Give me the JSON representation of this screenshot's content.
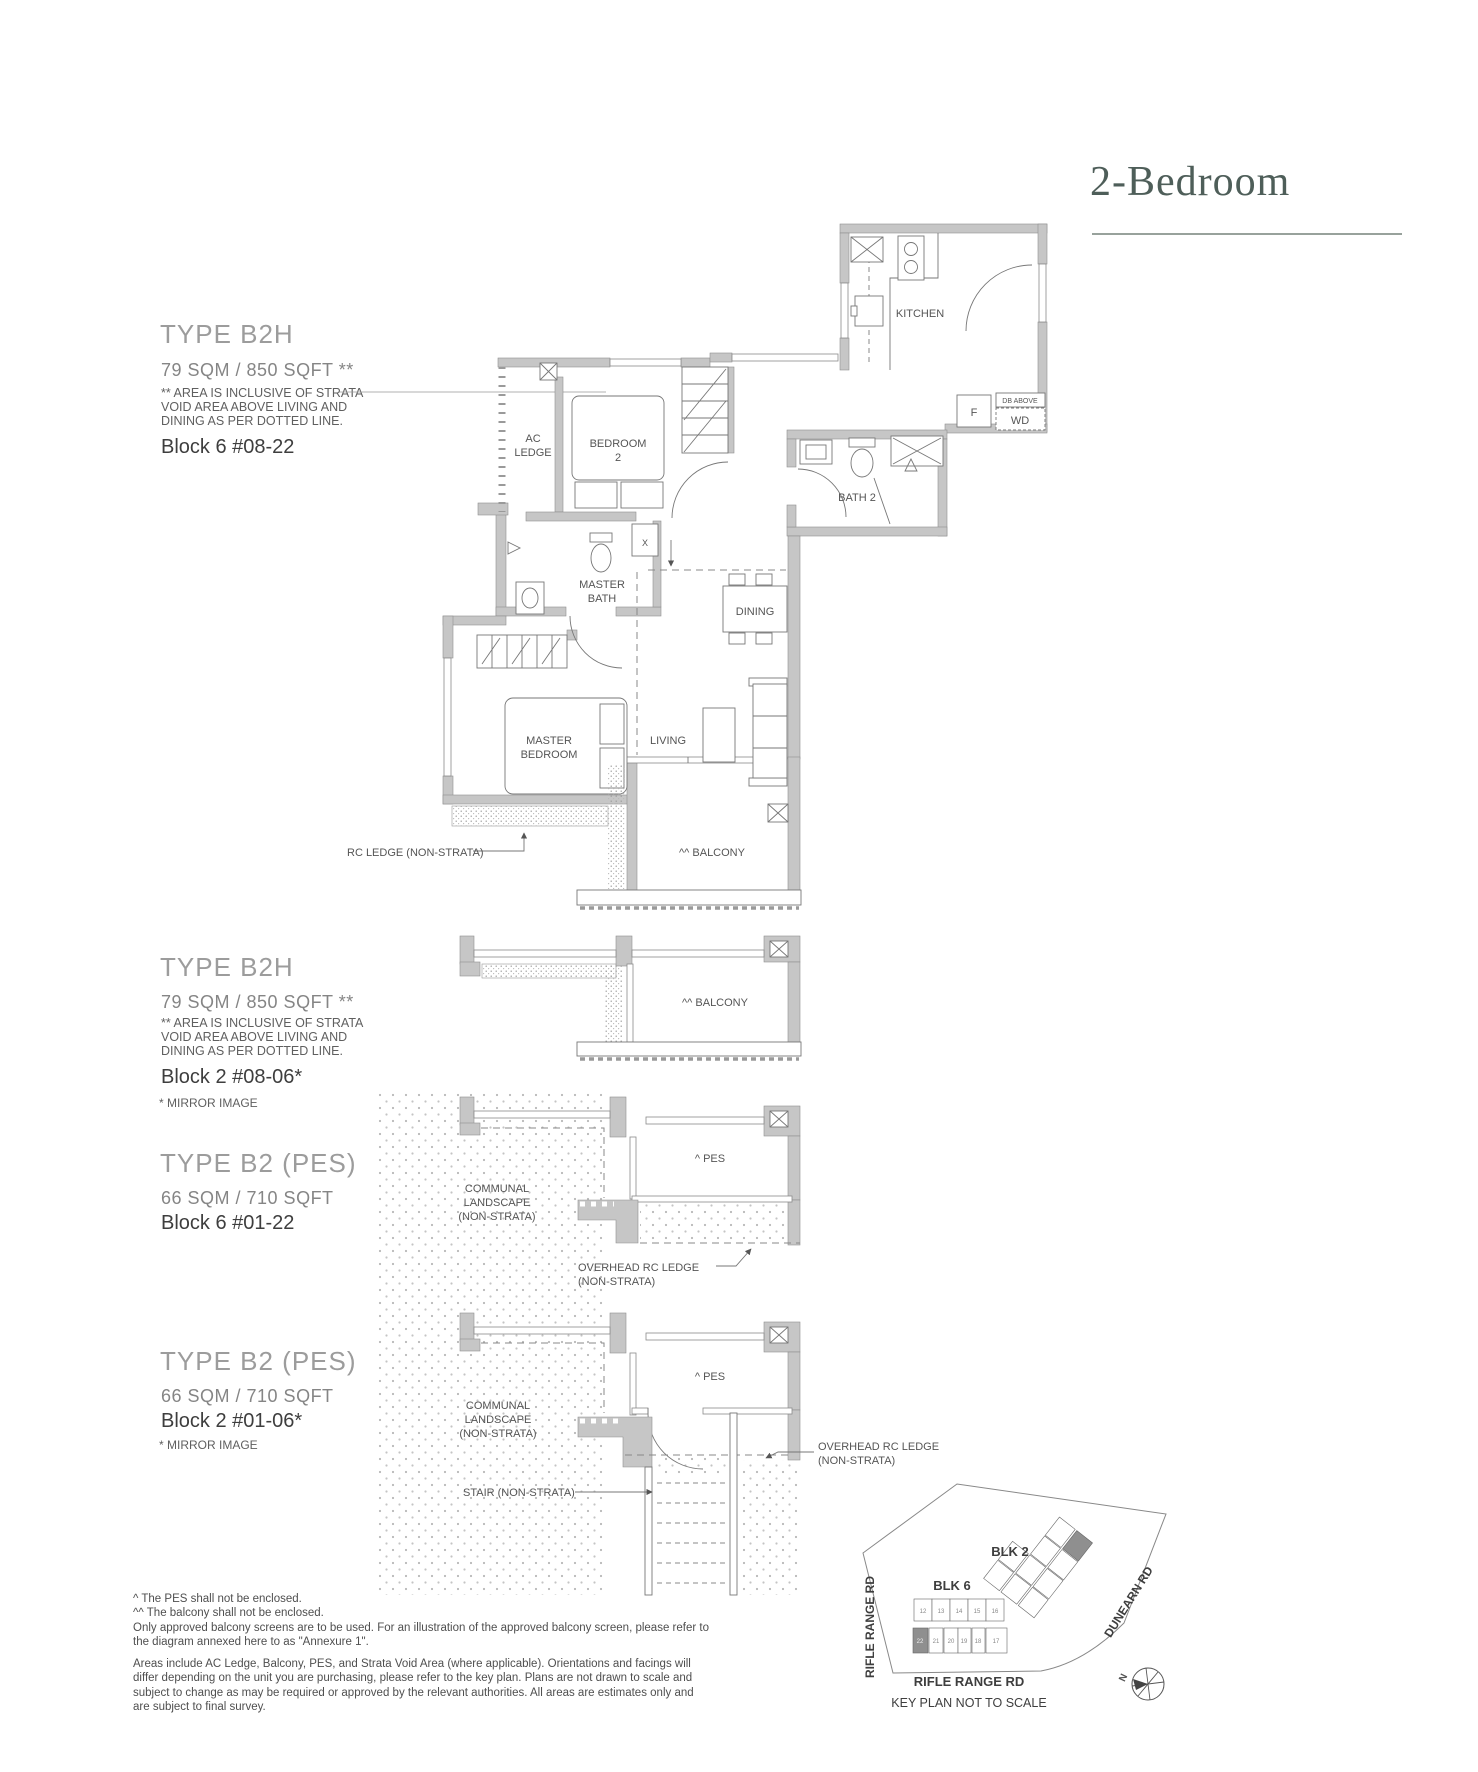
{
  "title": "2-Bedroom",
  "sections": {
    "s1": {
      "type": "TYPE B2H",
      "area": "79 SQM / 850 SQFT **",
      "note1": "** AREA IS INCLUSIVE OF STRATA",
      "note2": "VOID AREA ABOVE LIVING AND",
      "note3": "DINING AS PER DOTTED LINE.",
      "block": "Block 6 #08-22"
    },
    "s2": {
      "type": "TYPE B2H",
      "area": "79 SQM / 850 SQFT **",
      "note1": "** AREA IS INCLUSIVE OF STRATA",
      "note2": "VOID AREA ABOVE LIVING AND",
      "note3": "DINING AS PER DOTTED LINE.",
      "block": "Block 2 #08-06*",
      "mirror": "* MIRROR IMAGE"
    },
    "s3": {
      "type": "TYPE B2 (PES)",
      "area": "66 SQM / 710 SQFT",
      "block": "Block 6 #01-22"
    },
    "s4": {
      "type": "TYPE B2 (PES)",
      "area": "66 SQM / 710 SQFT",
      "block": "Block 2 #01-06*",
      "mirror": "* MIRROR IMAGE"
    }
  },
  "plan_main": {
    "ac1": "AC",
    "ac2": "LEDGE",
    "bedroom2a": "BEDROOM",
    "bedroom2b": "2",
    "kitchen": "KITCHEN",
    "fridge": "F",
    "db": "DB ABOVE",
    "wd": "WD",
    "bath2": "BATH 2",
    "mbath1": "MASTER",
    "mbath2": "BATH",
    "dining": "DINING",
    "mbr1": "MASTER",
    "mbr2": "BEDROOM",
    "living": "LIVING",
    "balcony": "^^ BALCONY",
    "shaft": "X",
    "rc_ledge": "RC LEDGE (NON-STRATA)"
  },
  "plan_balcony": {
    "balcony": "^^ BALCONY"
  },
  "plan_pes1": {
    "pes": "^ PES",
    "communal1": "COMMUNAL",
    "communal2": "LANDSCAPE",
    "communal3": "(NON-STRATA)",
    "ledge1": "OVERHEAD RC LEDGE",
    "ledge2": "(NON-STRATA)"
  },
  "plan_pes2": {
    "pes": "^ PES",
    "communal1": "COMMUNAL",
    "communal2": "LANDSCAPE",
    "communal3": "(NON-STRATA)",
    "ledge1": "OVERHEAD RC LEDGE",
    "ledge2": "(NON-STRATA)",
    "stair": "STAIR (NON-STRATA)"
  },
  "footnotes": {
    "l1": "^  The PES shall not be enclosed.",
    "l2": "^^ The balcony shall not be enclosed.",
    "l3": "Only approved balcony screens are to be used. For an illustration of the approved balcony screen, please refer to",
    "l4": "the diagram annexed here to as \"Annexure 1\".",
    "p1": "Areas include AC Ledge, Balcony, PES, and Strata Void Area (where applicable). Orientations and facings will",
    "p2": "differ depending on the unit you are purchasing, please refer to the key plan. Plans are not drawn to scale and",
    "p3": "subject to change as may be required or approved by the relevant authorities. All areas are estimates only and",
    "p4": "are subject to final survey."
  },
  "keyplan": {
    "blk2": "BLK 2",
    "blk6": "BLK 6",
    "road_left": "RIFLE RANGE RD",
    "road_right": "DUNEAR RD",
    "road_right_full": "DUNEARN RD",
    "road_bottom": "RIFLE RANGE RD",
    "caption": "KEY PLAN NOT TO SCALE",
    "north": "N",
    "blk6_top": [
      "12",
      "13",
      "14",
      "15",
      "16"
    ],
    "blk6_bottom": [
      "22",
      "21",
      "20",
      "19",
      "18",
      "17"
    ]
  },
  "colors": {
    "title": "#4e5e59",
    "wall_fill": "#c6c6c6",
    "line": "#6f6f6f"
  }
}
